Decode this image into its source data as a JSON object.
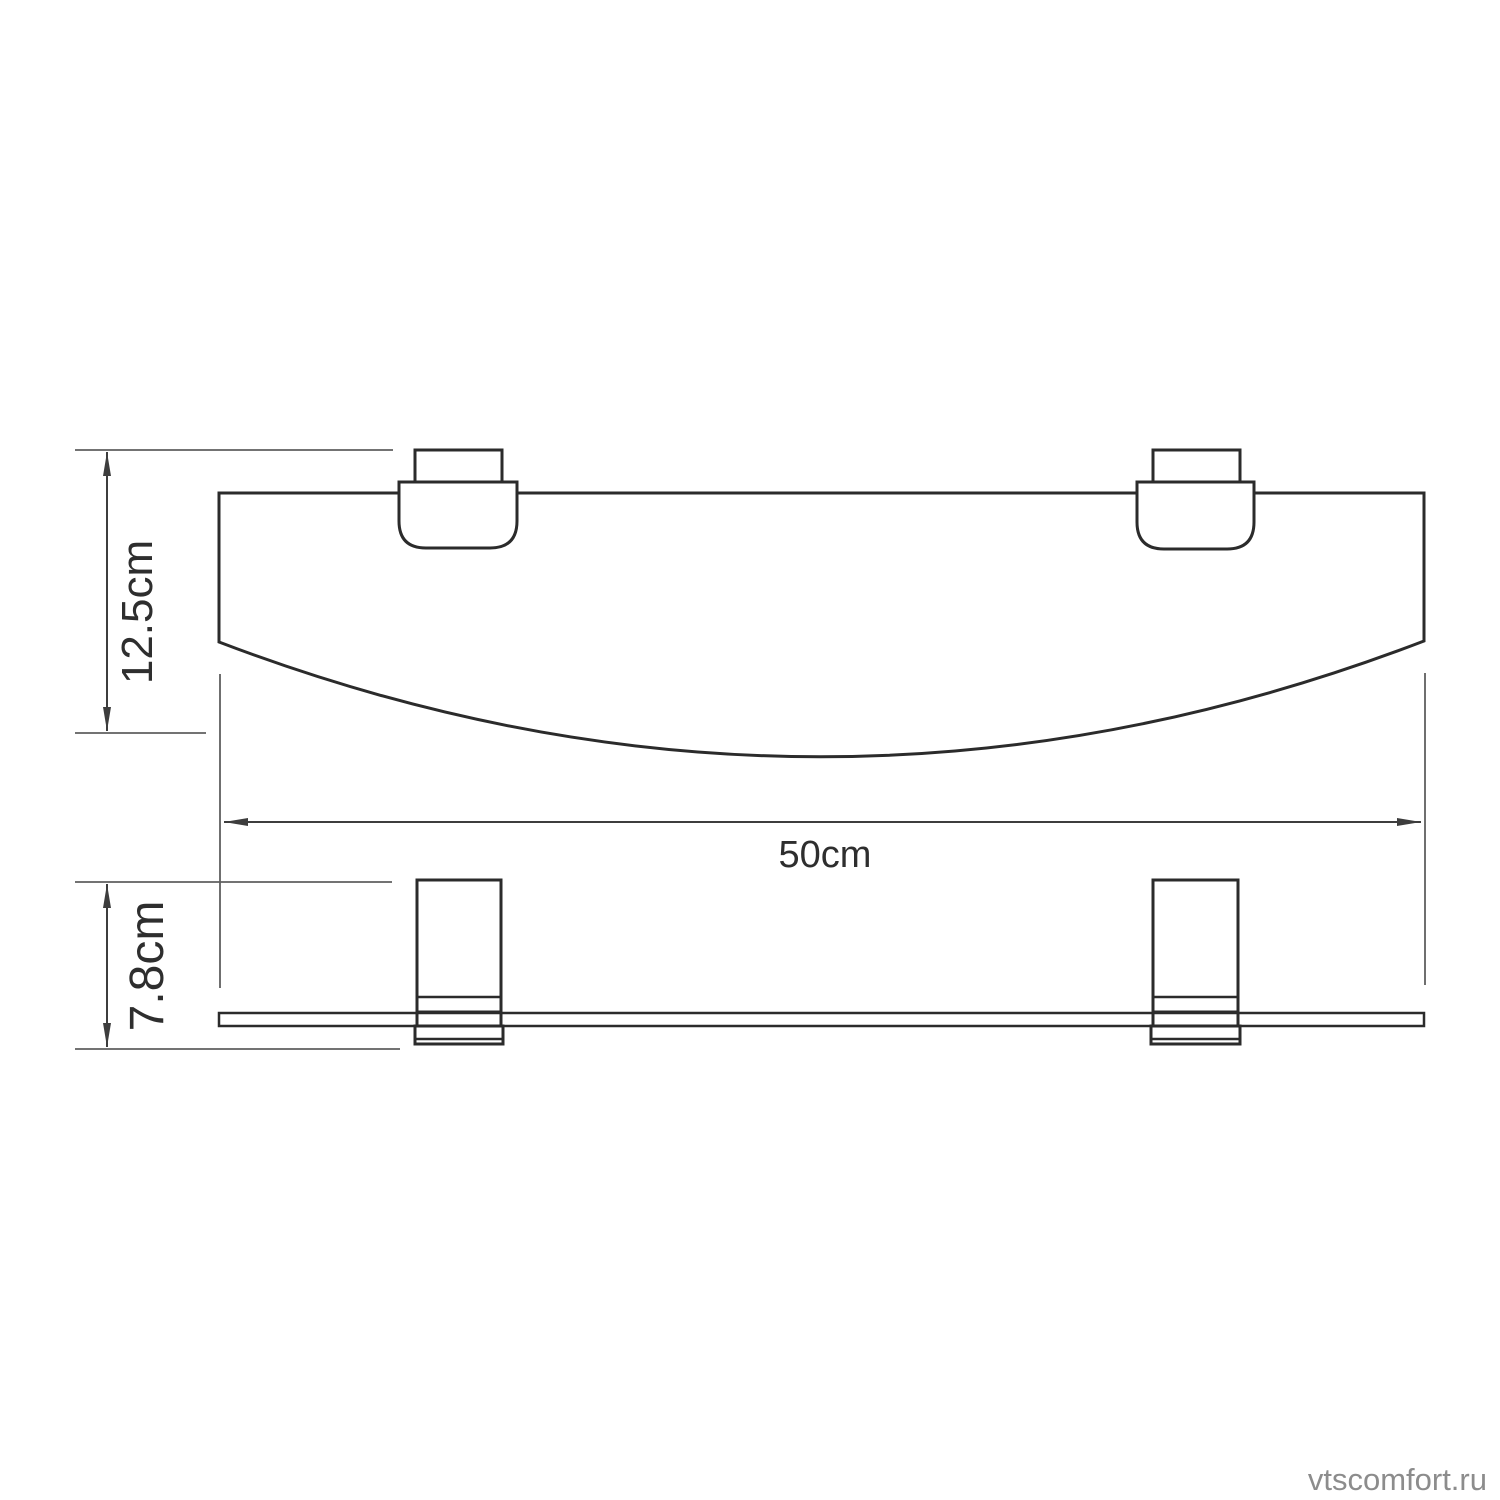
{
  "diagram": {
    "type": "technical-dimension-drawing",
    "subject": "wall-mounted curved glass shelf with two brackets, top view and front view",
    "labels": {
      "depth": "12.5cm",
      "width": "50cm",
      "height": "7.8cm"
    }
  },
  "watermark": {
    "text": "vtscomfort.ru"
  },
  "colors": {
    "outline": "#2b2b2b",
    "dimension_lines": "#3d3d3d",
    "extension_lines": "#5f5f5f",
    "watermark": "#8c8c8c",
    "background": "#ffffff"
  }
}
